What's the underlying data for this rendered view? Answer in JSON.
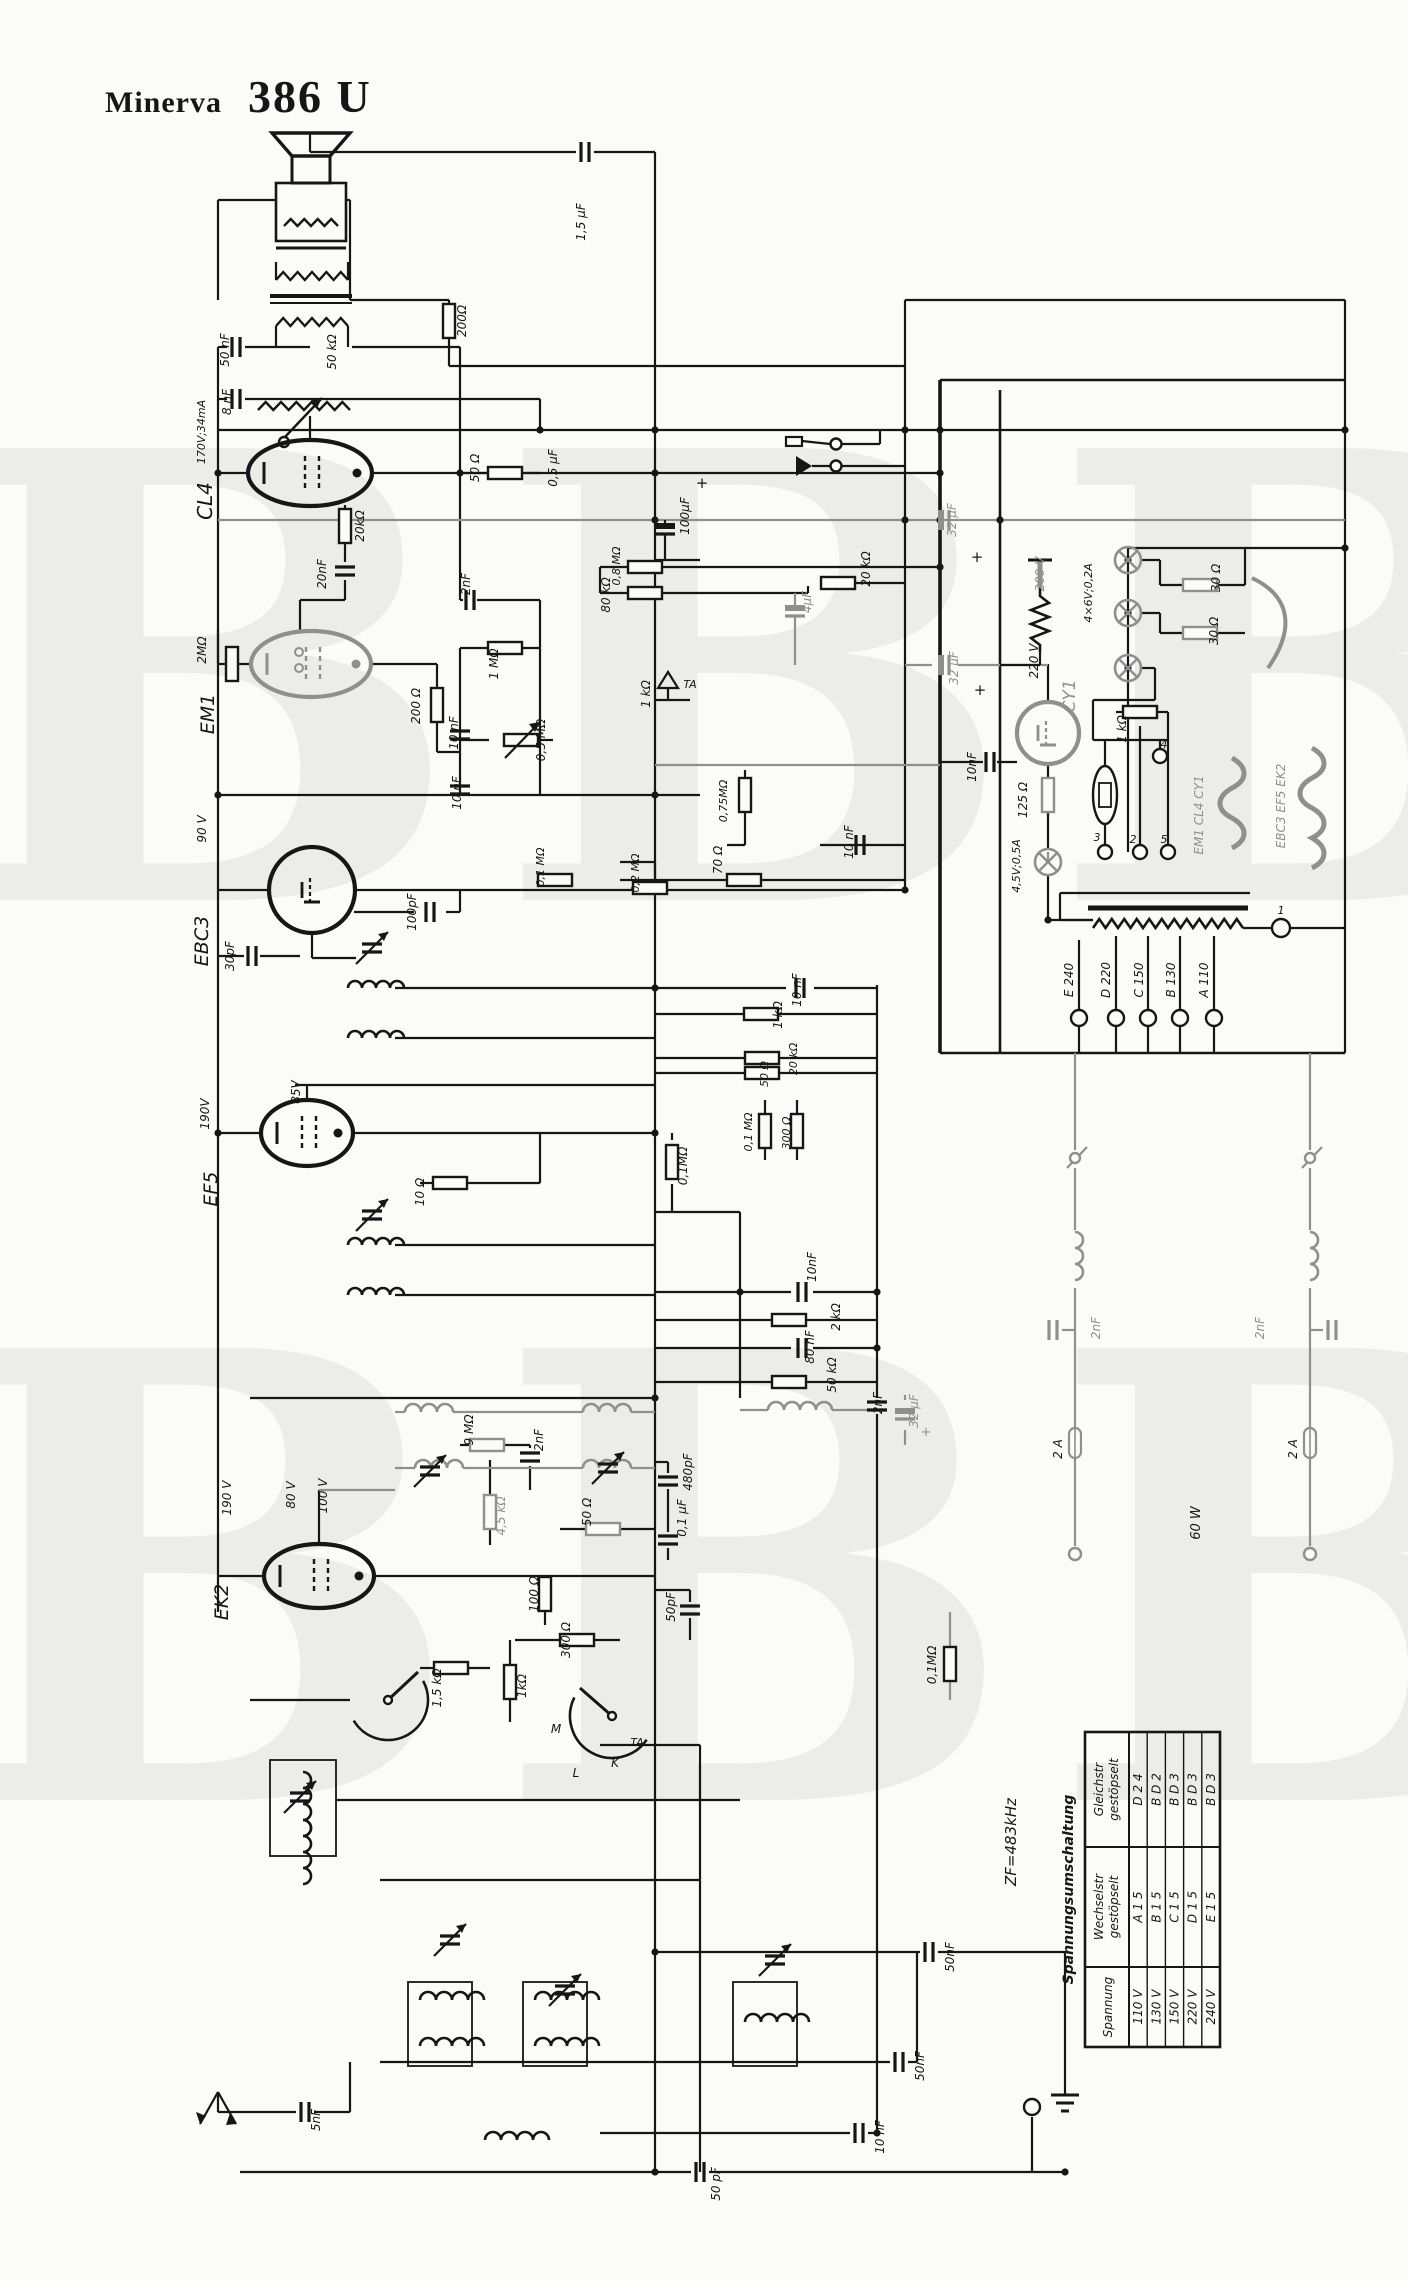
{
  "header": {
    "brand": "Minerva",
    "model": "386 U"
  },
  "watermark": {
    "text": "BBBB",
    "color": "#ECECE8"
  },
  "palette": {
    "paper": "#fbfbf8",
    "ink": "#161616",
    "faded": "#8f8f8d"
  },
  "schematic": {
    "labels": [
      {
        "t": "1,5 µF",
        "x": 585,
        "y": 222
      },
      {
        "t": "200Ω",
        "x": 466,
        "y": 321
      },
      {
        "t": "50 nF",
        "x": 229,
        "y": 350
      },
      {
        "t": "50 kΩ",
        "x": 336,
        "y": 352
      },
      {
        "t": "8 nF",
        "x": 231,
        "y": 402
      },
      {
        "t": "170V;34mA",
        "x": 205,
        "y": 432,
        "s": 11
      },
      {
        "t": "CL4",
        "x": 212,
        "y": 501,
        "s": 20
      },
      {
        "t": "20kΩ",
        "x": 364,
        "y": 526
      },
      {
        "t": "20nF",
        "x": 326,
        "y": 574
      },
      {
        "t": "50 Ω",
        "x": 479,
        "y": 468
      },
      {
        "t": "0,5 µF",
        "x": 557,
        "y": 468
      },
      {
        "t": "2nF",
        "x": 470,
        "y": 584
      },
      {
        "t": "1 MΩ",
        "x": 498,
        "y": 664
      },
      {
        "t": "2MΩ",
        "x": 206,
        "y": 650
      },
      {
        "t": "EM1",
        "x": 214,
        "y": 714,
        "s": 19
      },
      {
        "t": "200 Ω",
        "x": 420,
        "y": 706
      },
      {
        "t": "10 nF",
        "x": 458,
        "y": 733
      },
      {
        "t": "0,5 MΩ",
        "x": 545,
        "y": 740
      },
      {
        "t": "10 nF",
        "x": 461,
        "y": 793
      },
      {
        "t": "90 V",
        "x": 206,
        "y": 829
      },
      {
        "t": "EBC3",
        "x": 208,
        "y": 941,
        "s": 19
      },
      {
        "t": "100pF",
        "x": 416,
        "y": 912
      },
      {
        "t": "30pF",
        "x": 234,
        "y": 956
      },
      {
        "t": "0,1 MΩ",
        "x": 544,
        "y": 867,
        "s": 11
      },
      {
        "t": "0,2 MΩ",
        "x": 639,
        "y": 873,
        "s": 11
      },
      {
        "t": "70 Ω",
        "x": 722,
        "y": 860
      },
      {
        "t": "0,75MΩ",
        "x": 727,
        "y": 801,
        "s": 11
      },
      {
        "t": "10 nF",
        "x": 853,
        "y": 842
      },
      {
        "t": "0,8 MΩ",
        "x": 620,
        "y": 566,
        "s": 11
      },
      {
        "t": "80 kΩ",
        "x": 610,
        "y": 595
      },
      {
        "t": "20 kΩ",
        "x": 870,
        "y": 569
      },
      {
        "t": "4µF",
        "x": 811,
        "y": 602,
        "g": true
      },
      {
        "t": "100µF",
        "x": 689,
        "y": 516
      },
      {
        "t": "+",
        "x": 702,
        "y": 488,
        "r": 0,
        "s": 15
      },
      {
        "t": "32 µF",
        "x": 956,
        "y": 520,
        "g": true
      },
      {
        "t": "+",
        "x": 977,
        "y": 562,
        "r": 0,
        "s": 15
      },
      {
        "t": "32 µF",
        "x": 958,
        "y": 668,
        "g": true
      },
      {
        "t": "+",
        "x": 980,
        "y": 695,
        "r": 0,
        "s": 15
      },
      {
        "t": "200 V",
        "x": 1044,
        "y": 574,
        "g": true
      },
      {
        "t": "220 V",
        "x": 1038,
        "y": 661
      },
      {
        "t": "CY1",
        "x": 1075,
        "y": 696,
        "s": 17,
        "g": true
      },
      {
        "t": "10nF",
        "x": 976,
        "y": 767
      },
      {
        "t": "125 Ω",
        "x": 1027,
        "y": 800
      },
      {
        "t": "4,5V;0,5A",
        "x": 1020,
        "y": 866,
        "s": 11
      },
      {
        "t": "4×6V;0,2A",
        "x": 1092,
        "y": 593,
        "s": 11
      },
      {
        "t": "30 Ω",
        "x": 1220,
        "y": 578
      },
      {
        "t": "30 Ω",
        "x": 1218,
        "y": 631
      },
      {
        "t": "1 kΩ",
        "x": 1126,
        "y": 729
      },
      {
        "t": "4",
        "x": 1164,
        "y": 748,
        "r": 0,
        "s": 11
      },
      {
        "t": "3",
        "x": 1097,
        "y": 841,
        "r": 0,
        "s": 11
      },
      {
        "t": "2",
        "x": 1133,
        "y": 843,
        "r": 0,
        "s": 11
      },
      {
        "t": "5",
        "x": 1164,
        "y": 843,
        "r": 0,
        "s": 11
      },
      {
        "t": "EM1 CL4 CY1",
        "x": 1203,
        "y": 815,
        "g": true
      },
      {
        "t": "EBC3 EF5 EK2",
        "x": 1285,
        "y": 806,
        "g": true
      },
      {
        "t": "E 240",
        "x": 1073,
        "y": 980
      },
      {
        "t": "D 220",
        "x": 1110,
        "y": 980
      },
      {
        "t": "C 150",
        "x": 1143,
        "y": 980
      },
      {
        "t": "B 130",
        "x": 1175,
        "y": 980
      },
      {
        "t": "A 110",
        "x": 1208,
        "y": 980
      },
      {
        "t": "1",
        "x": 1281,
        "y": 914,
        "r": 0,
        "s": 11
      },
      {
        "t": "2nF",
        "x": 1100,
        "y": 1328,
        "g": true
      },
      {
        "t": "2nF",
        "x": 1264,
        "y": 1328,
        "g": true
      },
      {
        "t": "2 A",
        "x": 1062,
        "y": 1449
      },
      {
        "t": "2 A",
        "x": 1297,
        "y": 1449
      },
      {
        "t": "60 W",
        "x": 1200,
        "y": 1523,
        "s": 13
      },
      {
        "t": "0,1MΩ",
        "x": 936,
        "y": 1665
      },
      {
        "t": "190V",
        "x": 209,
        "y": 1114
      },
      {
        "t": "85V",
        "x": 300,
        "y": 1092
      },
      {
        "t": "EF5",
        "x": 217,
        "y": 1189,
        "s": 19
      },
      {
        "t": "10 Ω",
        "x": 424,
        "y": 1192
      },
      {
        "t": "10nF",
        "x": 816,
        "y": 1267
      },
      {
        "t": "2 kΩ",
        "x": 840,
        "y": 1317
      },
      {
        "t": "80 nF",
        "x": 814,
        "y": 1347
      },
      {
        "t": "50 kΩ",
        "x": 836,
        "y": 1375
      },
      {
        "t": "10 nF",
        "x": 801,
        "y": 990
      },
      {
        "t": "1 kΩ",
        "x": 782,
        "y": 1015
      },
      {
        "t": "20 kΩ",
        "x": 797,
        "y": 1059,
        "s": 11
      },
      {
        "t": "50 Ω",
        "x": 768,
        "y": 1074,
        "s": 11
      },
      {
        "t": "0,1 MΩ",
        "x": 752,
        "y": 1132,
        "s": 11
      },
      {
        "t": "300 Ω",
        "x": 790,
        "y": 1133,
        "s": 11
      },
      {
        "t": "32 µF",
        "x": 918,
        "y": 1411,
        "g": true
      },
      {
        "t": "+",
        "x": 926,
        "y": 1436,
        "r": 0,
        "s": 13,
        "g": true
      },
      {
        "t": "2nF",
        "x": 882,
        "y": 1403
      },
      {
        "t": "190 V",
        "x": 231,
        "y": 1498
      },
      {
        "t": "80 V",
        "x": 295,
        "y": 1495
      },
      {
        "t": "100 V",
        "x": 327,
        "y": 1496
      },
      {
        "t": "EK2",
        "x": 228,
        "y": 1602,
        "s": 19
      },
      {
        "t": "9 MΩ",
        "x": 473,
        "y": 1430
      },
      {
        "t": "2nF",
        "x": 543,
        "y": 1440
      },
      {
        "t": "4,5 kΩ",
        "x": 505,
        "y": 1516,
        "g": true
      },
      {
        "t": "50 Ω",
        "x": 591,
        "y": 1512
      },
      {
        "t": "480pF",
        "x": 692,
        "y": 1472
      },
      {
        "t": "0,1 µF",
        "x": 686,
        "y": 1518
      },
      {
        "t": "50pF",
        "x": 675,
        "y": 1607
      },
      {
        "t": "100 Ω",
        "x": 538,
        "y": 1594
      },
      {
        "t": "300 Ω",
        "x": 570,
        "y": 1640
      },
      {
        "t": "1,5 kΩ",
        "x": 441,
        "y": 1688
      },
      {
        "t": "1kΩ",
        "x": 526,
        "y": 1686
      },
      {
        "t": "M",
        "x": 556,
        "y": 1733,
        "r": 0,
        "s": 12
      },
      {
        "t": "L",
        "x": 576,
        "y": 1777,
        "r": 0,
        "s": 12
      },
      {
        "t": "K",
        "x": 615,
        "y": 1767,
        "r": 0,
        "s": 12
      },
      {
        "t": "TA",
        "x": 637,
        "y": 1746,
        "r": 0,
        "s": 11
      },
      {
        "t": "TA",
        "x": 690,
        "y": 688,
        "r": 0,
        "s": 11
      },
      {
        "t": "1 kΩ",
        "x": 650,
        "y": 694
      },
      {
        "t": "0,1MΩ",
        "x": 687,
        "y": 1166
      },
      {
        "t": "5nF",
        "x": 320,
        "y": 2120
      },
      {
        "t": "50nF",
        "x": 954,
        "y": 1957
      },
      {
        "t": "50nF",
        "x": 924,
        "y": 2066
      },
      {
        "t": "10 nF",
        "x": 884,
        "y": 2137
      },
      {
        "t": "50 pF",
        "x": 720,
        "y": 2184
      },
      {
        "t": "ZF=483kHz",
        "x": 1016,
        "y": 1842,
        "s": 15
      }
    ]
  },
  "voltage_table": {
    "title": "Spannungsumschaltung",
    "columns": [
      [
        "Spannung"
      ],
      [
        "Wechselstr",
        "gestöpselt"
      ],
      [
        "Gleichstr",
        "gestöpselt"
      ]
    ],
    "rows": [
      [
        "110 V",
        "A 1 5",
        "D 2 4"
      ],
      [
        "130 V",
        "B 1 5",
        "B D 2"
      ],
      [
        "150 V",
        "C 1 5",
        "B D 3"
      ],
      [
        "220 V",
        "D 1 5",
        "B D 3"
      ],
      [
        "240 V",
        "E 1 5",
        "B D 3"
      ]
    ]
  }
}
